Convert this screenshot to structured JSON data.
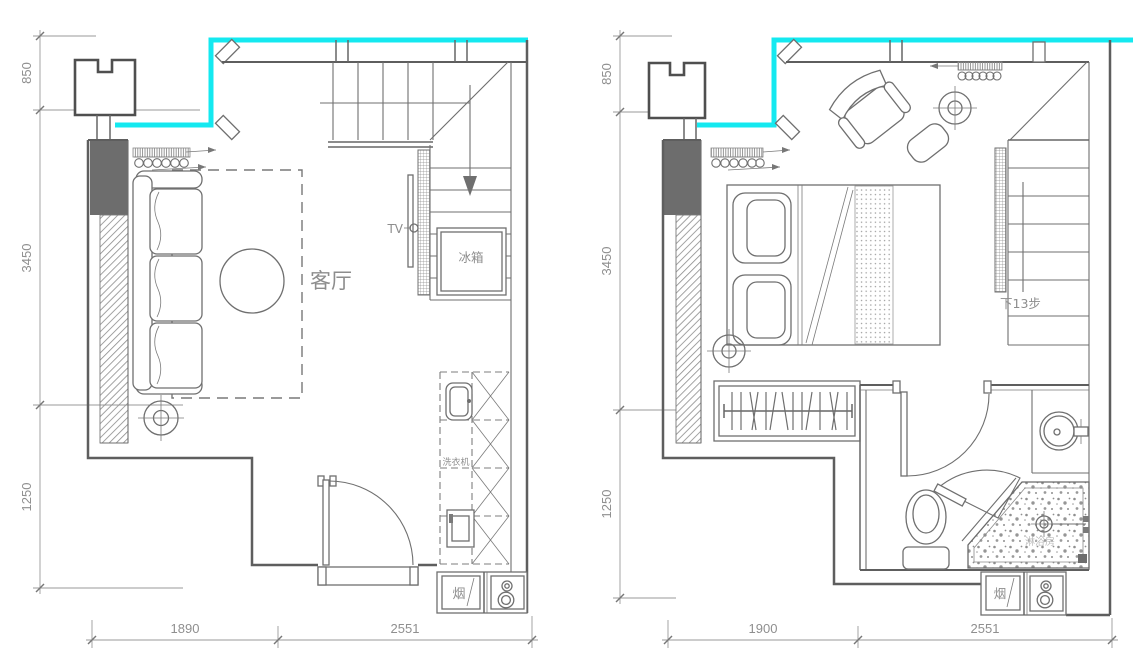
{
  "left_plan": {
    "labels": {
      "room": "客厅",
      "tv": "TV",
      "fridge": "冰箱",
      "washer": "洗衣机",
      "flue": "烟"
    },
    "dimensions": {
      "side": [
        "850",
        "3450",
        "1250"
      ],
      "bottom": [
        "1890",
        "2551"
      ]
    }
  },
  "right_plan": {
    "labels": {
      "stair_note": "下13步",
      "flue": "烟",
      "shower": "淋浴房"
    },
    "dimensions": {
      "side": [
        "850",
        "3450",
        "1250"
      ],
      "bottom": [
        "1900",
        "2551"
      ]
    }
  },
  "colors": {
    "window_accent": "#14e9f0",
    "line": "#6a6a6a",
    "wall_fill": "#6d6d6d",
    "dim_text": "#8f8f8f"
  },
  "symbols": {
    "ceiling_lamp": "crosshair-circle",
    "curtain": "spring-coil",
    "window_band": "cyan-line",
    "stair_direction": "down-arrow"
  }
}
